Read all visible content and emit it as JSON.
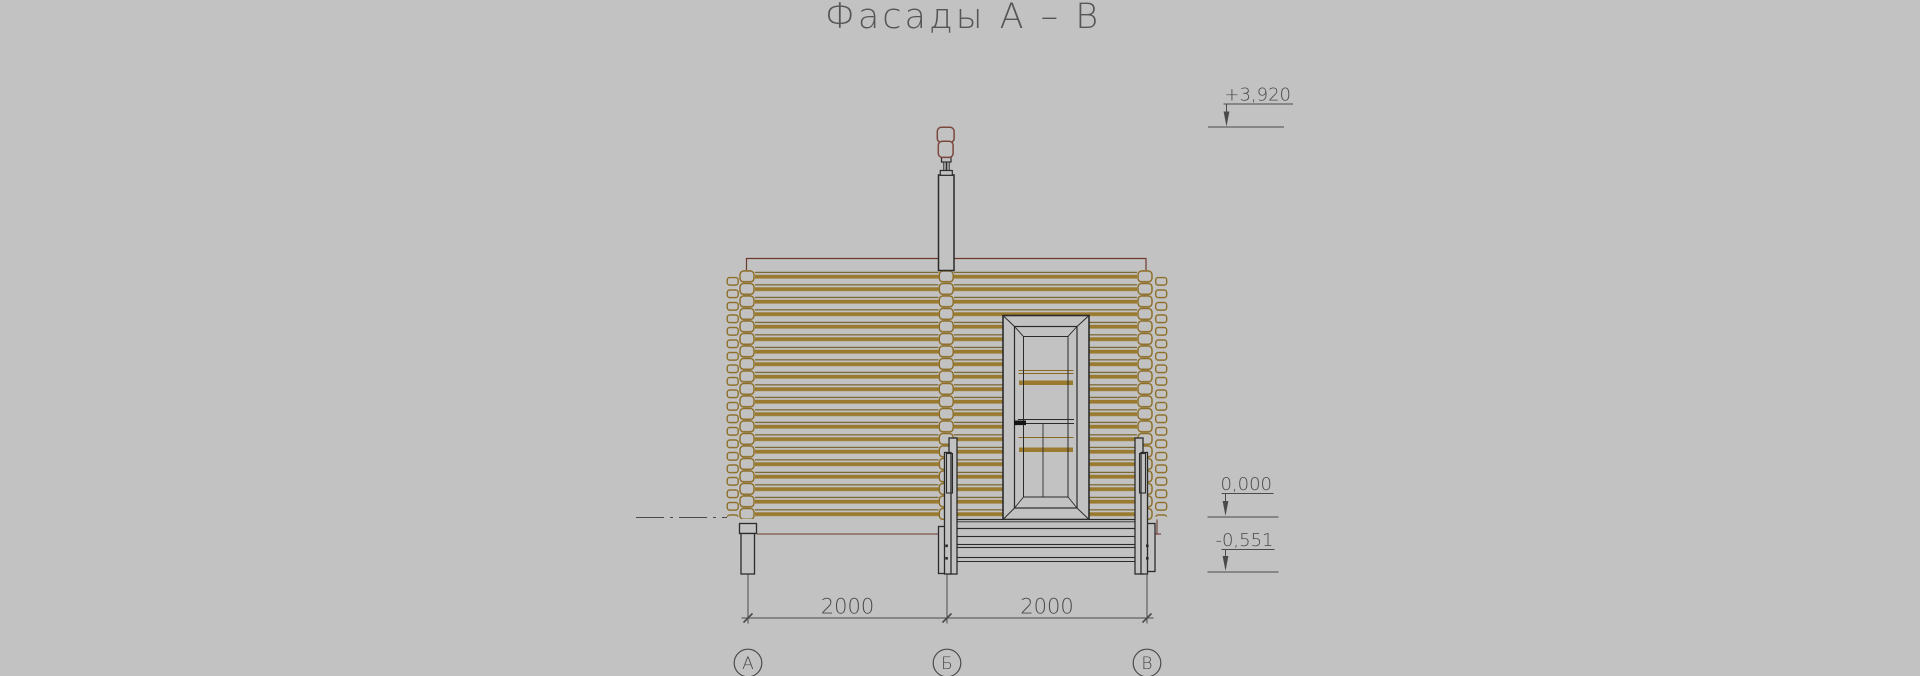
{
  "title": "Фасады А – В",
  "drawing": {
    "type": "architectural-facade-elevation",
    "subject": "log cabin facade with chimney, glazed door and porch deck",
    "axis_labels": {
      "a": "А",
      "b": "Б",
      "v": "В"
    },
    "dimensions": {
      "span_ab": "2000",
      "span_bv": "2000"
    },
    "elevations": {
      "chimney_top": "+3,920",
      "floor": "0,000",
      "ground": "-0,551"
    }
  },
  "colors": {
    "background": "#c2c2c2",
    "log_band": "#9a7a2e",
    "log_thin_line": "#6f5a1c",
    "log_end_outline": "#8a6a20",
    "outline_dark": "#2b2b2b",
    "roof_floor_accent": "#6e3a2e",
    "chimney_cap_outline": "#7b463c",
    "annotation_text": "#4a4a4a"
  }
}
